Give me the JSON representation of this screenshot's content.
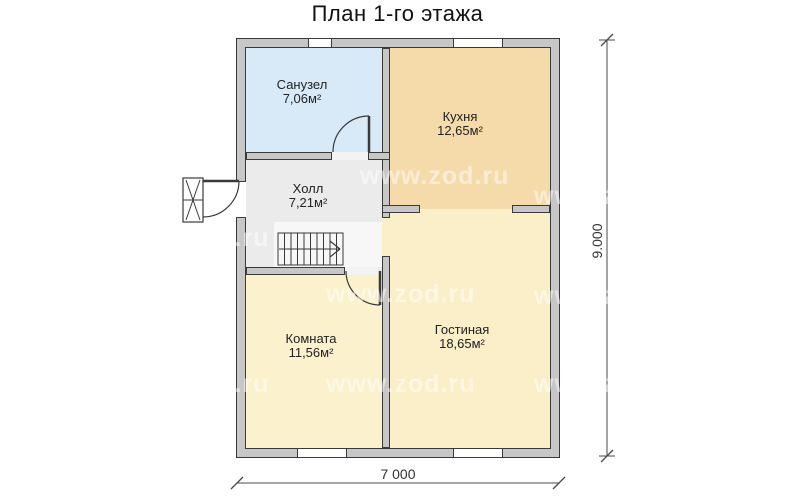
{
  "title": "План 1-го этажа",
  "watermark": "www.zod.ru",
  "colors": {
    "canvas": "#ffffff",
    "wall_fill": "#c7c7c7",
    "line": "#3a3a3a",
    "dim_line": "#4a4a4a",
    "text": "#1c1c1c",
    "bathroom": "#d8eaf8",
    "kitchen": "#f6dbaa",
    "hall": "#ebebeb",
    "stair_zone": "#f7f7f7",
    "room": "#fbf1cd",
    "living": "#faefc8",
    "gap_floor": "#f3f3f3",
    "watermark_color": "rgba(255,255,255,0.5)"
  },
  "rooms": [
    {
      "id": "bathroom",
      "name": "Санузел",
      "area": "7,06м²"
    },
    {
      "id": "kitchen",
      "name": "Кухня",
      "area": "12,65м²"
    },
    {
      "id": "hall",
      "name": "Холл",
      "area": "7,21м²"
    },
    {
      "id": "room",
      "name": "Комната",
      "area": "11,56м²"
    },
    {
      "id": "living",
      "name": "Гостиная",
      "area": "18,65м²"
    }
  ],
  "dimensions": {
    "vertical": "9.000",
    "horizontal": "7 000"
  }
}
